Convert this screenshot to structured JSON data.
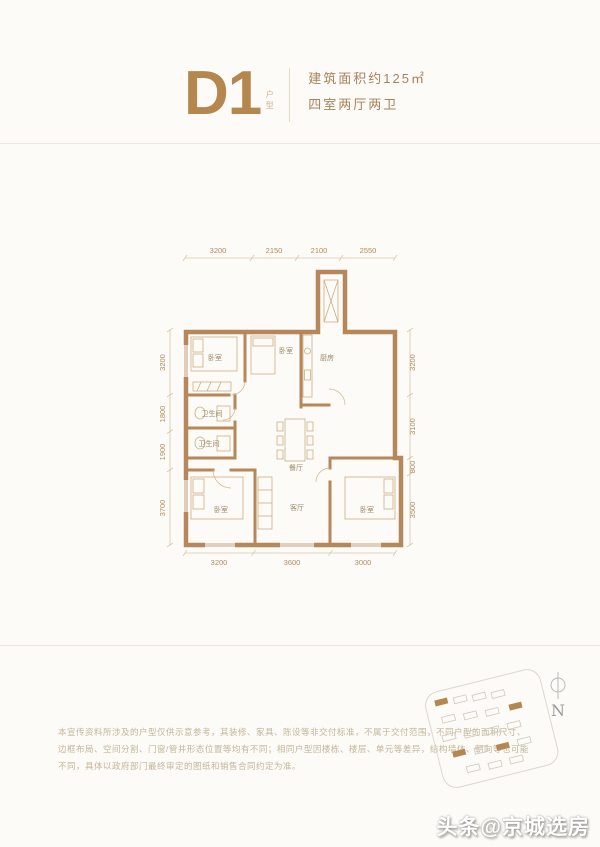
{
  "header": {
    "unit_code": "D1",
    "unit_type_label": "户型",
    "area_text": "建筑面积约125㎡",
    "layout_text": "四室两厅两卫"
  },
  "plan": {
    "dims": {
      "top": [
        "3200",
        "2150",
        "2100",
        "2550"
      ],
      "bottom": [
        "3200",
        "3600",
        "3000"
      ],
      "left": [
        "3200",
        "1800",
        "1900",
        "3700"
      ],
      "right": [
        "3200",
        "3100",
        "800",
        "3500"
      ]
    },
    "rooms": {
      "bedroom_tl": "卧室",
      "bedroom_tm": "卧室",
      "kitchen": "厨房",
      "bath_1": "卫生间",
      "bath_2": "卫生间",
      "dining": "餐厅",
      "bedroom_bl": "卧室",
      "living": "客厅",
      "bedroom_br": "卧室"
    }
  },
  "disclaimer": {
    "line1": "本宣传资料所涉及的户型仅供示意参考，其装修、家具、陈设等非交付标准，不属于交付范围，不同户型的面积尺寸、",
    "line2": "边框布局、空间分割、门窗/管井形态位置等均有不同；相同户型因楼栋、楼层、单元等差异，结构墙体、朝向等也可能",
    "line3": "不同，具体以政府部门最终审定的图纸和销售合同约定为准。"
  },
  "siteplan": {
    "north_label": "N"
  },
  "watermark": "头条@京城选房",
  "colors": {
    "accent": "#b5874f",
    "wall": "#b6875a",
    "dim_line": "#cfb28a",
    "background": "#fcfbf7"
  }
}
